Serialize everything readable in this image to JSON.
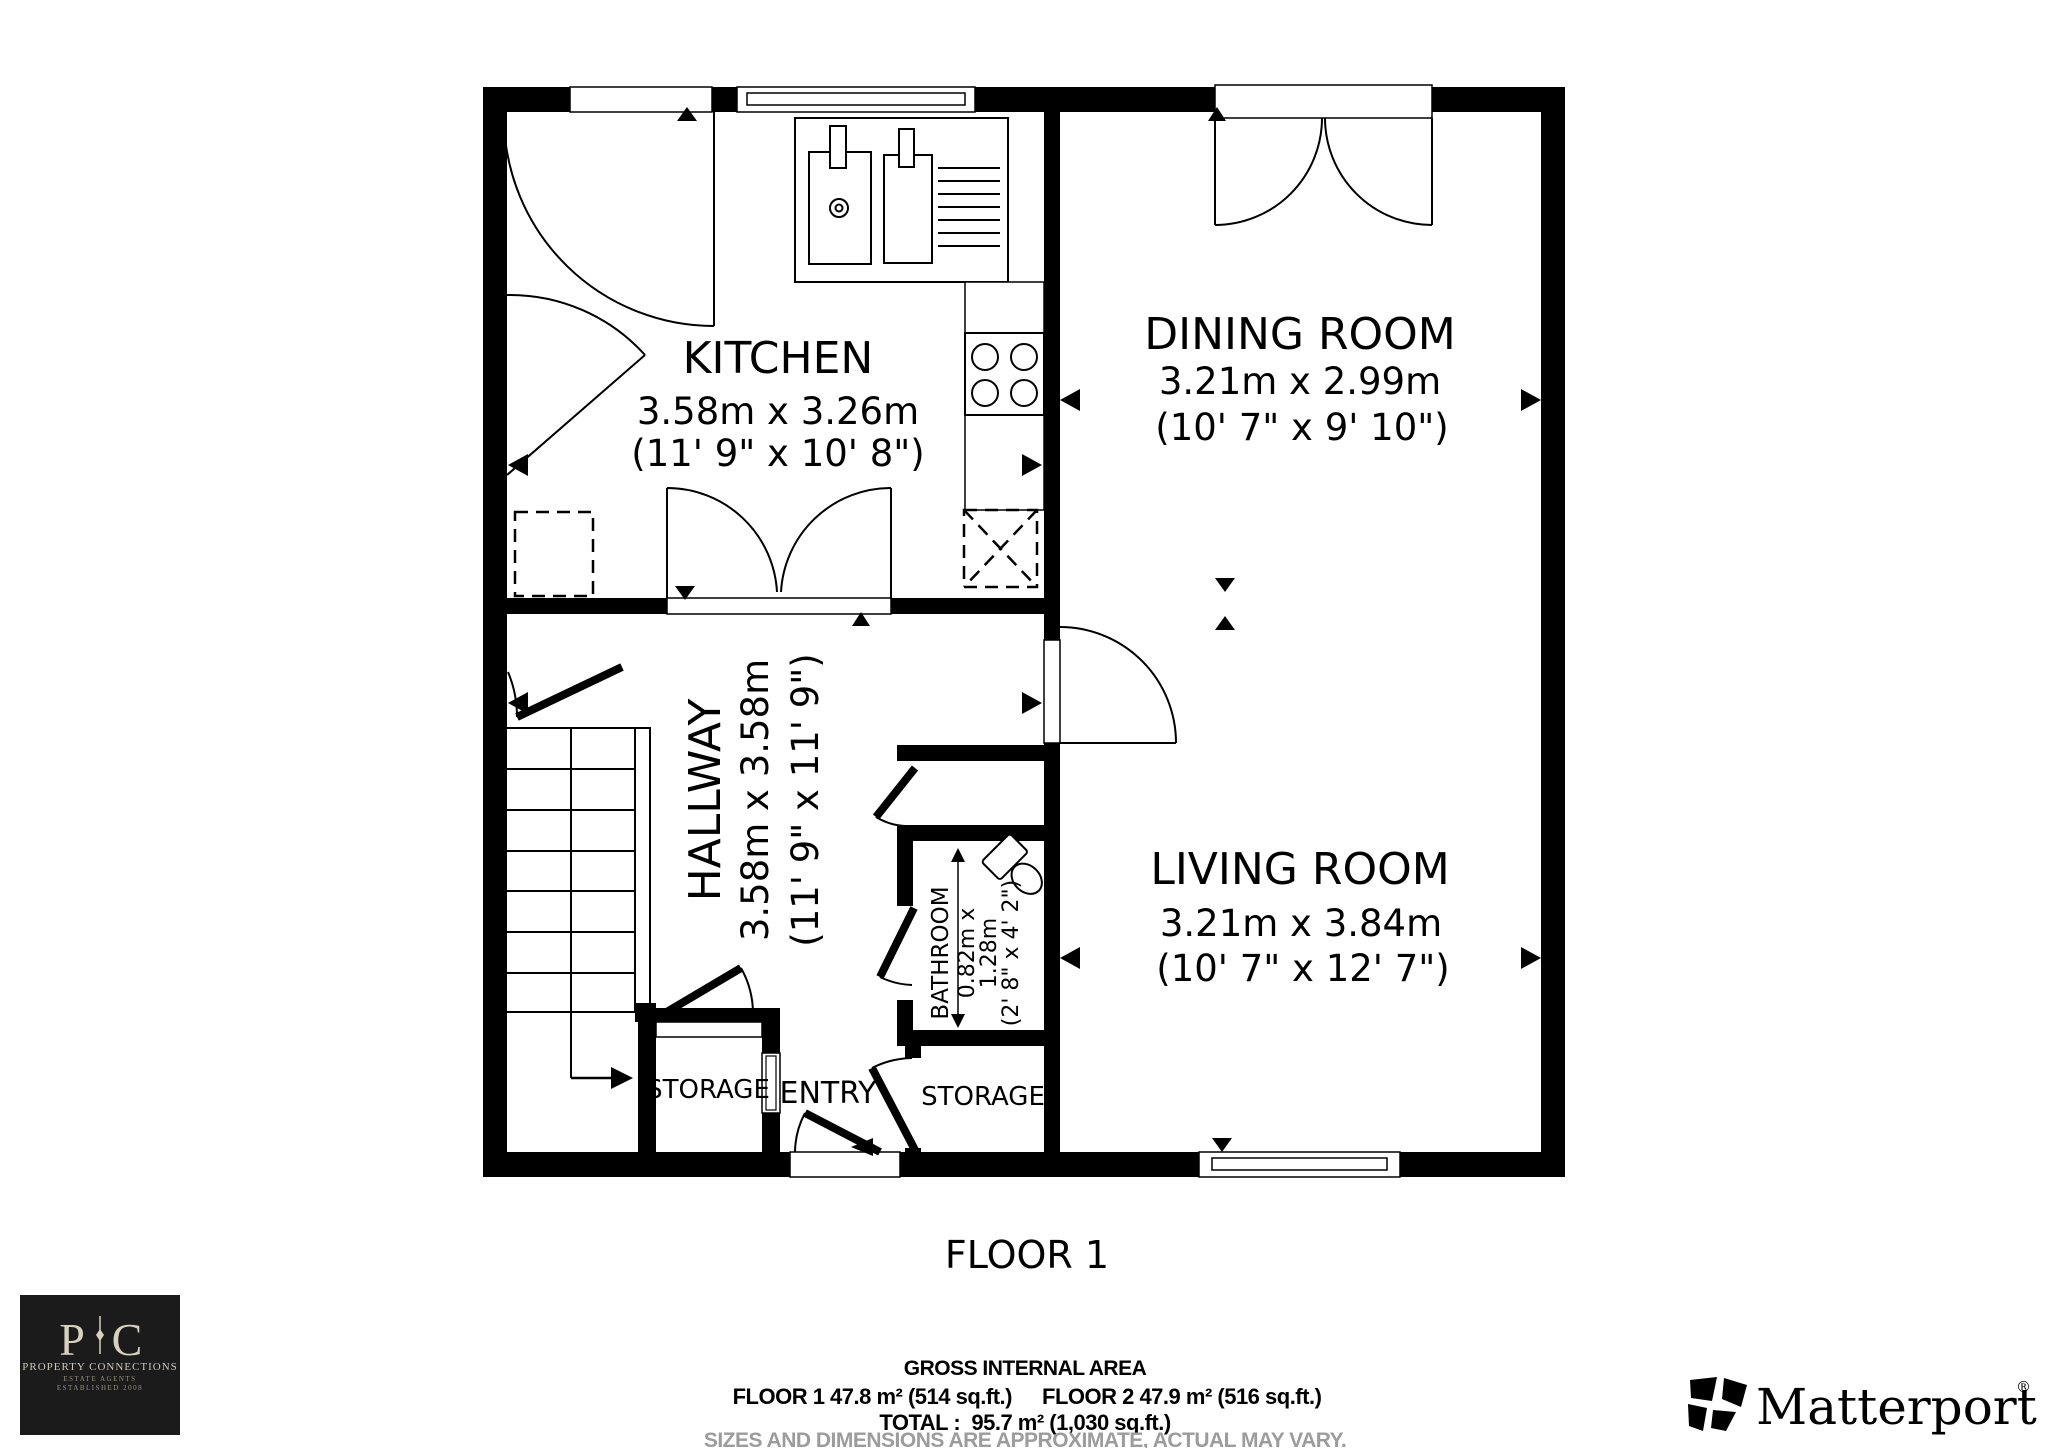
{
  "floor_plan": {
    "floor_label": "FLOOR 1",
    "rooms": {
      "kitchen": {
        "name": "KITCHEN",
        "metric": "3.58m x 3.26m",
        "imperial": "(11' 9\" x 10' 8\")"
      },
      "dining": {
        "name": "DINING ROOM",
        "metric": "3.21m x 2.99m",
        "imperial": "(10' 7\" x 9' 10\")"
      },
      "hallway": {
        "name": "HALLWAY",
        "metric": "3.58m x 3.58m",
        "imperial": "(11' 9\" x 11' 9\")"
      },
      "living": {
        "name": "LIVING ROOM",
        "metric": "3.21m x 3.84m",
        "imperial": "(10' 7\" x 12' 7\")"
      },
      "bathroom": {
        "name": "BATHROOM",
        "metric_line1": "0.82m x",
        "metric_line2": "1.28m",
        "imperial": "(2' 8\" x 4' 2\")"
      },
      "storage_left": {
        "name": "STORAGE"
      },
      "storage_right": {
        "name": "STORAGE"
      },
      "entry": {
        "name": "ENTRY"
      }
    },
    "icons": [
      "door-swing-icon",
      "double-door-icon",
      "window-icon",
      "stairs-icon",
      "sink-icon",
      "hob-icon",
      "toilet-icon",
      "dimension-arrow-icon"
    ]
  },
  "area_summary": {
    "title": "GROSS INTERNAL AREA",
    "floor1": "FLOOR 1 47.8 m² (514 sq.ft.)",
    "floor2": "FLOOR 2 47.9 m² (516 sq.ft.)",
    "total": "TOTAL :  95.7 m² (1,030 sq.ft.)",
    "disclaimer": "SIZES AND DIMENSIONS ARE APPROXIMATE, ACTUAL MAY VARY."
  },
  "branding": {
    "agency": {
      "monogram_left": "P",
      "monogram_right": "C",
      "name": "PROPERTY CONNECTIONS",
      "tagline1": "ESTATE AGENTS",
      "tagline2": "ESTABLISHED 2008"
    },
    "matterport": {
      "wordmark": "Matterport",
      "registered": "®"
    }
  },
  "colors": {
    "wall": "#000000",
    "background": "#ffffff",
    "disclaimer_gray": "#9c9c9c",
    "agency_bg": "#1b1b1b",
    "agency_text": "#d9d1c0"
  }
}
